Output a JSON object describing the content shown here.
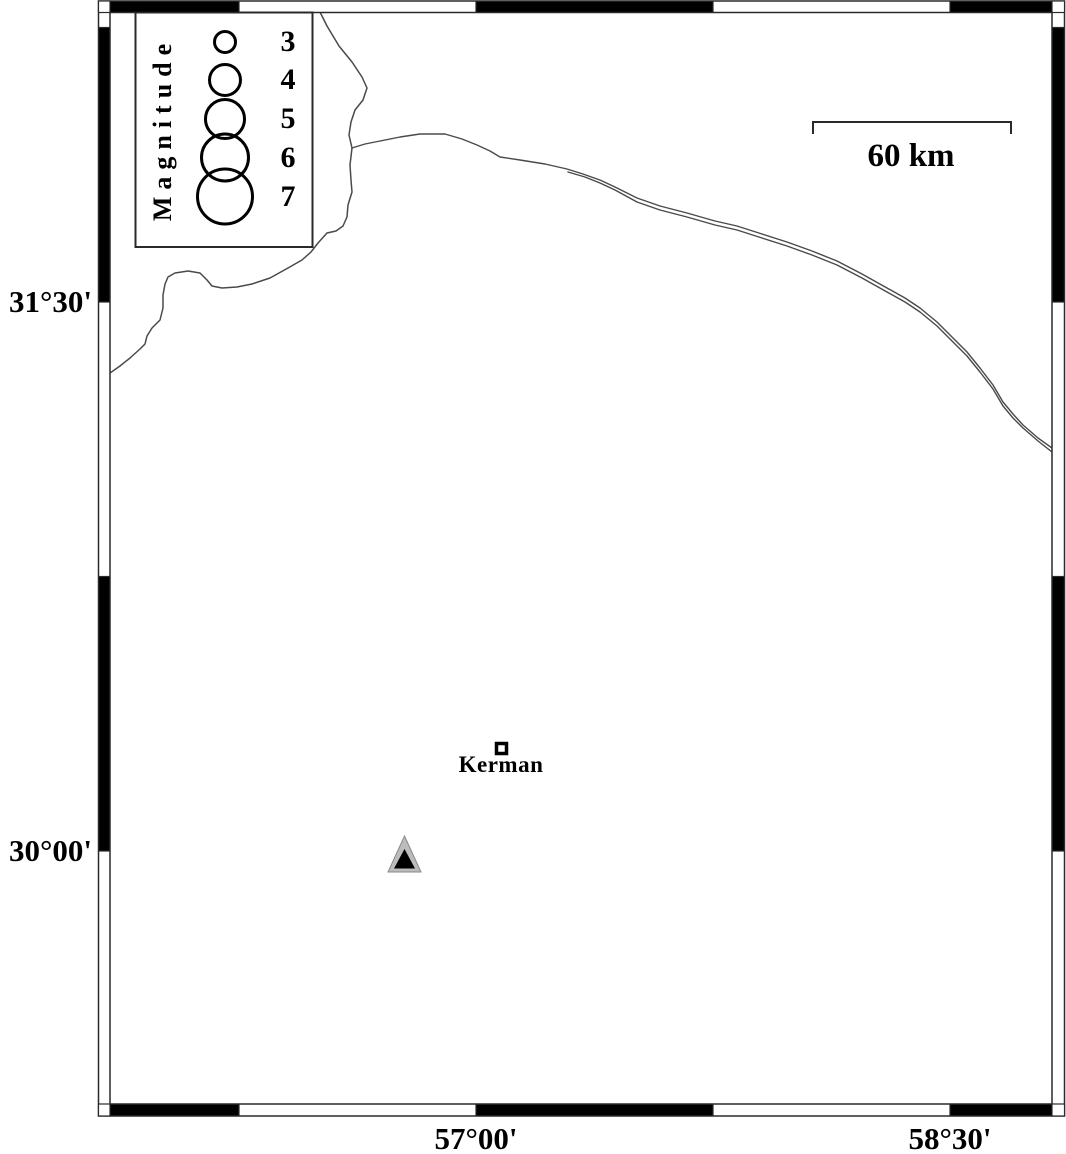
{
  "frame": {
    "lat_top": "31°30'",
    "lat_bottom": "30°00'",
    "lon_left": "57°00'",
    "lon_right": "58°30'"
  },
  "legend": {
    "title": "Magnitude",
    "entries": [
      {
        "label": "3"
      },
      {
        "label": "4"
      },
      {
        "label": "5"
      },
      {
        "label": "6"
      },
      {
        "label": "7"
      }
    ]
  },
  "scalebar": {
    "label": "60 km"
  },
  "city": {
    "label": "Kerman"
  },
  "colors": {
    "ink": "#000000",
    "frame_line": "#2a2a2a",
    "map_line": "#4a4a4a",
    "station_fill": "#bcbcbc",
    "station_edge": "#8a8a8a"
  }
}
